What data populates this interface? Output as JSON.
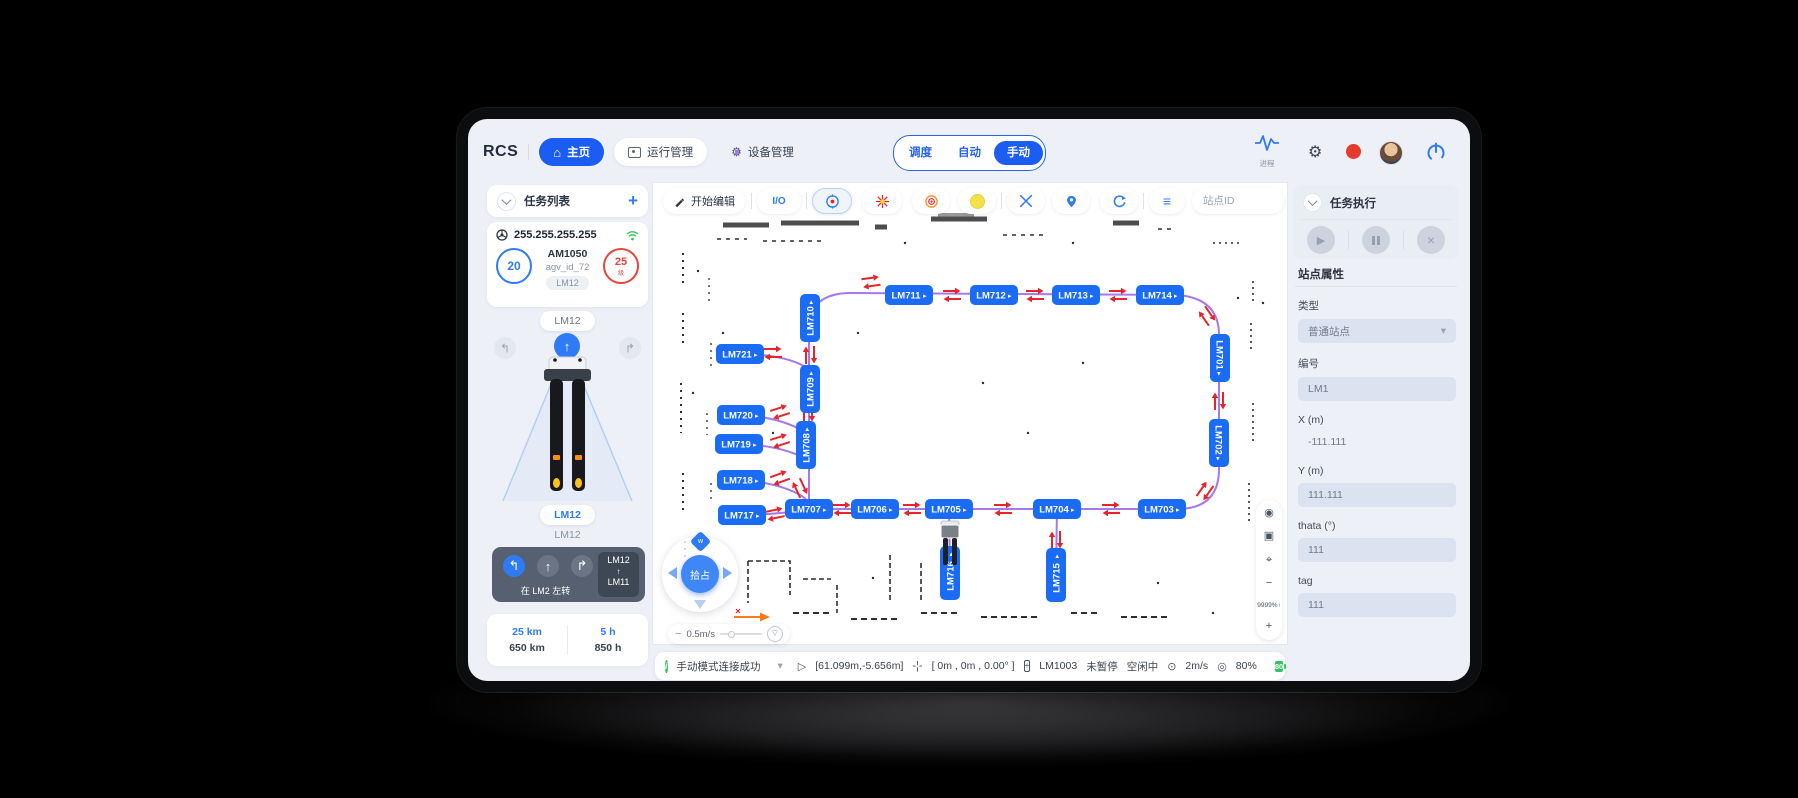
{
  "topbar": {
    "logo": "RCS",
    "nav": [
      {
        "label": "主页"
      },
      {
        "label": "运行管理"
      },
      {
        "label": "设备管理"
      }
    ],
    "modes": [
      {
        "label": "调度"
      },
      {
        "label": "自动"
      },
      {
        "label": "手动"
      }
    ],
    "process_label": "进程"
  },
  "left_panel": {
    "title": "任务列表",
    "add_label": "+",
    "ip": "255.255.255.255",
    "agv": {
      "count_badge": "20",
      "model": "AM1050",
      "agv_id": "agv_id_72",
      "station_tag": "LM12",
      "battery_value": "25",
      "battery_unit": "级"
    },
    "pill_top": "LM12",
    "pill_bottom": "LM12",
    "text_bottom": "LM12",
    "route": {
      "from": "LM12",
      "to": "LM11",
      "action": "在 LM2 左转"
    },
    "stats": [
      {
        "top": "25 km",
        "bottom": "650 km"
      },
      {
        "top": "5 h",
        "bottom": "850 h"
      }
    ]
  },
  "map_toolbar": {
    "edit_label": "开始编辑",
    "io_label": "I/O",
    "search_placeholder": "站点ID"
  },
  "map": {
    "joystick_label": "拾占",
    "speed_label": "0.5m/s",
    "zoom_label": "9999%↑",
    "nodes": [
      {
        "id": "LM710",
        "x": 157,
        "y": 135,
        "o": "v",
        "t": "up"
      },
      {
        "id": "LM721",
        "x": 87,
        "y": 171,
        "o": "h",
        "t": "right"
      },
      {
        "id": "LM711",
        "x": 256,
        "y": 112,
        "o": "h",
        "t": "right"
      },
      {
        "id": "LM712",
        "x": 341,
        "y": 112,
        "o": "h",
        "t": "right"
      },
      {
        "id": "LM713",
        "x": 423,
        "y": 112,
        "o": "h",
        "t": "right"
      },
      {
        "id": "LM714",
        "x": 507,
        "y": 112,
        "o": "h",
        "t": "right"
      },
      {
        "id": "LM701",
        "x": 567,
        "y": 175,
        "o": "v",
        "t": "down"
      },
      {
        "id": "LM709",
        "x": 157,
        "y": 206,
        "o": "v",
        "t": "up"
      },
      {
        "id": "LM720",
        "x": 88,
        "y": 232,
        "o": "h",
        "t": "right"
      },
      {
        "id": "LM719",
        "x": 86,
        "y": 261,
        "o": "h",
        "t": "right"
      },
      {
        "id": "LM708",
        "x": 153,
        "y": 262,
        "o": "v",
        "t": "up"
      },
      {
        "id": "LM702",
        "x": 566,
        "y": 260,
        "o": "v",
        "t": "down"
      },
      {
        "id": "LM718",
        "x": 88,
        "y": 297,
        "o": "h",
        "t": "right"
      },
      {
        "id": "LM717",
        "x": 89,
        "y": 332,
        "o": "h",
        "t": "right"
      },
      {
        "id": "LM707",
        "x": 156,
        "y": 326,
        "o": "h",
        "t": "right"
      },
      {
        "id": "LM706",
        "x": 222,
        "y": 326,
        "o": "h",
        "t": "right"
      },
      {
        "id": "LM705",
        "x": 296,
        "y": 326,
        "o": "h",
        "t": "right"
      },
      {
        "id": "LM704",
        "x": 404,
        "y": 326,
        "o": "h",
        "t": "right"
      },
      {
        "id": "LM703",
        "x": 509,
        "y": 326,
        "o": "h",
        "t": "right"
      },
      {
        "id": "LM716",
        "x": 297,
        "y": 390,
        "o": "v",
        "t": "up",
        "l": 1
      },
      {
        "id": "LM715",
        "x": 403,
        "y": 392,
        "o": "v",
        "t": "up",
        "l": 1
      }
    ],
    "paths": [
      "M156,326 L156,146 Q156,110 198,110 L524,112 Q566,115 566,152 L566,286 Q566,326 524,326 L156,326",
      "M92,171 Q135,172 156,186",
      "M92,232 Q135,236 156,252",
      "M92,261 Q135,264 156,278",
      "M92,297 Q135,302 153,316",
      "M92,332 Q128,331 150,327",
      "M296,326 L297,384",
      "M404,326 L403,388"
    ],
    "arrows": [
      [
        218,
        99,
        -8
      ],
      [
        299,
        112,
        0
      ],
      [
        382,
        112,
        0
      ],
      [
        465,
        112,
        0
      ],
      [
        554,
        133,
        55
      ],
      [
        566,
        218,
        90
      ],
      [
        552,
        308,
        125
      ],
      [
        189,
        326,
        0
      ],
      [
        259,
        326,
        0
      ],
      [
        350,
        326,
        0
      ],
      [
        458,
        326,
        0
      ],
      [
        157,
        172,
        90
      ],
      [
        155,
        230,
        90
      ],
      [
        120,
        170,
        0
      ],
      [
        127,
        229,
        -18
      ],
      [
        127,
        258,
        -18
      ],
      [
        127,
        295,
        -20
      ],
      [
        122,
        331,
        -12
      ],
      [
        147,
        305,
        65
      ],
      [
        403,
        357,
        90
      ]
    ]
  },
  "right_panel": {
    "title": "任务执行",
    "section_title": "站点属性",
    "fields": [
      {
        "label": "类型",
        "value": "普通站点",
        "kind": "select"
      },
      {
        "label": "编号",
        "value": "LM1",
        "kind": "input"
      },
      {
        "label": "X (m)",
        "value": "-111.111",
        "kind": "plain"
      },
      {
        "label": "Y (m)",
        "value": "111.111",
        "kind": "input"
      },
      {
        "label": "thata (°)",
        "value": "111",
        "kind": "input"
      },
      {
        "label": "tag",
        "value": "111",
        "kind": "input"
      }
    ]
  },
  "statusbar": {
    "message": "手动模式连接成功",
    "coords": "[61.099m,-5.656m]",
    "pose": "[ 0m , 0m , 0.00° ]",
    "station": "LM1003",
    "pause": "未暂停",
    "idle": "空闲中",
    "speed": "2m/s",
    "load": "80%",
    "battery": "80"
  },
  "icons": {
    "turn_left": "↰",
    "forward": "↑",
    "turn_right": "↱",
    "play": "▶",
    "close": "×",
    "dropdown": "▾",
    "eye": "◉",
    "pip": "▣",
    "focus": "⌖",
    "minus": "−",
    "plus": "+",
    "funnel": "▽",
    "gear": "⚙",
    "home": "⌂",
    "menu": "≡",
    "speedometer": "⊙",
    "wheel": "◎",
    "cursor": "▷",
    "crosshair": "+"
  }
}
